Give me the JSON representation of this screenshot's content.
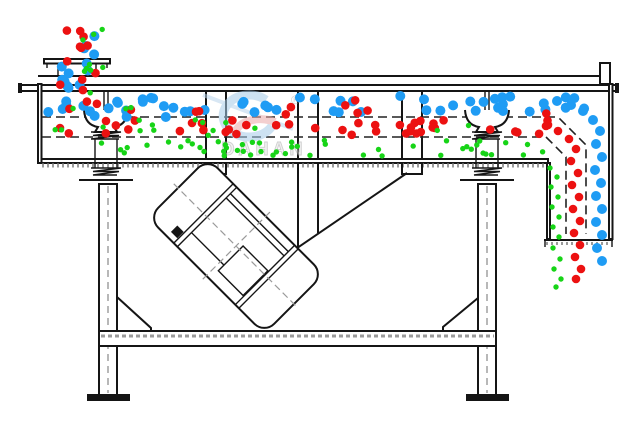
{
  "watermark": {
    "brand": "DAHAN",
    "registered": "®"
  },
  "colors": {
    "blue": "#1f9cf4",
    "red": "#ec1111",
    "green": "#17d417",
    "line": "#151515",
    "hatch_gray": "#999999",
    "watermark_blue": "#a6cbe9",
    "watermark_red": "#eba8a8",
    "watermark_text_fill": "#e6e6e6",
    "watermark_text_stroke": "#a9a9a9"
  },
  "particles": {
    "seed": 9,
    "radii": {
      "blue": 5,
      "red": 4.3,
      "green": 2.7
    },
    "bands": [
      {
        "c": "blue",
        "x1": 56,
        "x2": 100,
        "y1": 23,
        "y2": 92,
        "count": 13
      },
      {
        "c": "red",
        "x1": 58,
        "x2": 103,
        "y1": 26,
        "y2": 93,
        "count": 11
      },
      {
        "c": "green",
        "x1": 60,
        "x2": 106,
        "y1": 28,
        "y2": 94,
        "count": 9
      },
      {
        "c": "blue",
        "x1": 45,
        "x2": 598,
        "y1": 96,
        "y2": 113,
        "count": 46
      },
      {
        "c": "blue",
        "x1": 46,
        "x2": 200,
        "y1": 98,
        "y2": 118,
        "count": 10
      },
      {
        "c": "red",
        "x1": 44,
        "x2": 555,
        "y1": 98,
        "y2": 116,
        "count": 13
      },
      {
        "c": "red",
        "x1": 43,
        "x2": 552,
        "y1": 120,
        "y2": 135,
        "count": 42
      },
      {
        "c": "green",
        "x1": 46,
        "x2": 240,
        "y1": 100,
        "y2": 136,
        "count": 10
      },
      {
        "c": "green",
        "x1": 44,
        "x2": 470,
        "y1": 121,
        "y2": 136,
        "count": 8
      },
      {
        "c": "green",
        "x1": 43,
        "x2": 544,
        "y1": 140,
        "y2": 156,
        "count": 50
      }
    ],
    "placed": [
      {
        "c": "blue",
        "x": 557,
        "y": 101
      },
      {
        "c": "blue",
        "x": 571,
        "y": 105
      },
      {
        "c": "blue",
        "x": 583,
        "y": 111
      },
      {
        "c": "blue",
        "x": 593,
        "y": 120
      },
      {
        "c": "blue",
        "x": 600,
        "y": 131
      },
      {
        "c": "blue",
        "x": 596,
        "y": 144
      },
      {
        "c": "blue",
        "x": 602,
        "y": 157
      },
      {
        "c": "blue",
        "x": 595,
        "y": 170
      },
      {
        "c": "blue",
        "x": 601,
        "y": 183
      },
      {
        "c": "blue",
        "x": 596,
        "y": 196
      },
      {
        "c": "blue",
        "x": 602,
        "y": 209
      },
      {
        "c": "blue",
        "x": 596,
        "y": 222
      },
      {
        "c": "blue",
        "x": 602,
        "y": 235
      },
      {
        "c": "blue",
        "x": 597,
        "y": 248
      },
      {
        "c": "blue",
        "x": 602,
        "y": 261
      },
      {
        "c": "red",
        "x": 546,
        "y": 126
      },
      {
        "c": "red",
        "x": 558,
        "y": 131
      },
      {
        "c": "red",
        "x": 569,
        "y": 139
      },
      {
        "c": "red",
        "x": 576,
        "y": 149
      },
      {
        "c": "red",
        "x": 571,
        "y": 161
      },
      {
        "c": "red",
        "x": 578,
        "y": 173
      },
      {
        "c": "red",
        "x": 572,
        "y": 185
      },
      {
        "c": "red",
        "x": 579,
        "y": 197
      },
      {
        "c": "red",
        "x": 573,
        "y": 209
      },
      {
        "c": "red",
        "x": 580,
        "y": 221
      },
      {
        "c": "red",
        "x": 574,
        "y": 233
      },
      {
        "c": "red",
        "x": 580,
        "y": 245
      },
      {
        "c": "red",
        "x": 575,
        "y": 257
      },
      {
        "c": "red",
        "x": 581,
        "y": 269
      },
      {
        "c": "red",
        "x": 576,
        "y": 279
      },
      {
        "c": "green",
        "x": 550,
        "y": 168
      },
      {
        "c": "green",
        "x": 557,
        "y": 177
      },
      {
        "c": "green",
        "x": 551,
        "y": 187
      },
      {
        "c": "green",
        "x": 558,
        "y": 197
      },
      {
        "c": "green",
        "x": 552,
        "y": 207
      },
      {
        "c": "green",
        "x": 559,
        "y": 217
      },
      {
        "c": "green",
        "x": 553,
        "y": 227
      },
      {
        "c": "green",
        "x": 559,
        "y": 237
      },
      {
        "c": "green",
        "x": 553,
        "y": 248
      },
      {
        "c": "green",
        "x": 560,
        "y": 259
      },
      {
        "c": "green",
        "x": 554,
        "y": 269
      },
      {
        "c": "green",
        "x": 561,
        "y": 279
      },
      {
        "c": "green",
        "x": 556,
        "y": 287
      }
    ]
  }
}
